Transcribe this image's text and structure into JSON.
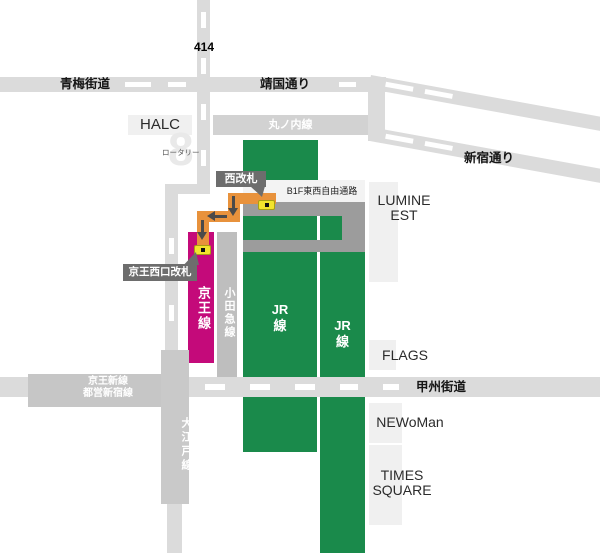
{
  "map": {
    "roads": {
      "route414": "414",
      "ome_kaido": "青梅街道",
      "yasukuni_dori": "靖国通り",
      "shinjuku_dori": "新宿通り",
      "koshu_kaido": "甲州街道"
    },
    "lines": {
      "marunouchi": "丸ノ内線",
      "keio": "京王線",
      "odakyu": "小田急線",
      "jr_west": "JR\n線",
      "jr_east": "JR\n線",
      "oedo": "大江戸線",
      "keio_new_toei_shinjuku": "京王新線\n都営新宿線"
    },
    "buildings": {
      "halc": "HALC",
      "lumine_est": "LUMINE\nEST",
      "flags": "FLAGS",
      "newoman": "NEWoMan",
      "times_square": "TIMES\nSQUARE"
    },
    "callouts": {
      "west_gate": "西改札",
      "keio_west_gate": "京王西口改札"
    },
    "annotations": {
      "b1f_passage": "B1F東西自由通路",
      "rotary": "ロータリー",
      "rotary_glyph": "8"
    },
    "icons": {
      "ticket_gate": "ticket-gate-icon",
      "route_arrows": "arrow-down-left-down"
    },
    "colors": {
      "jr_green": "#1a8a4b",
      "keio_magenta": "#c40a7a",
      "route_orange": "#e8923c",
      "gate_yellow": "#f2e42d",
      "road_gray": "#dbdbdb",
      "corridor_gray": "#9c9c9c",
      "callout_gray": "#6d6d6d"
    }
  }
}
